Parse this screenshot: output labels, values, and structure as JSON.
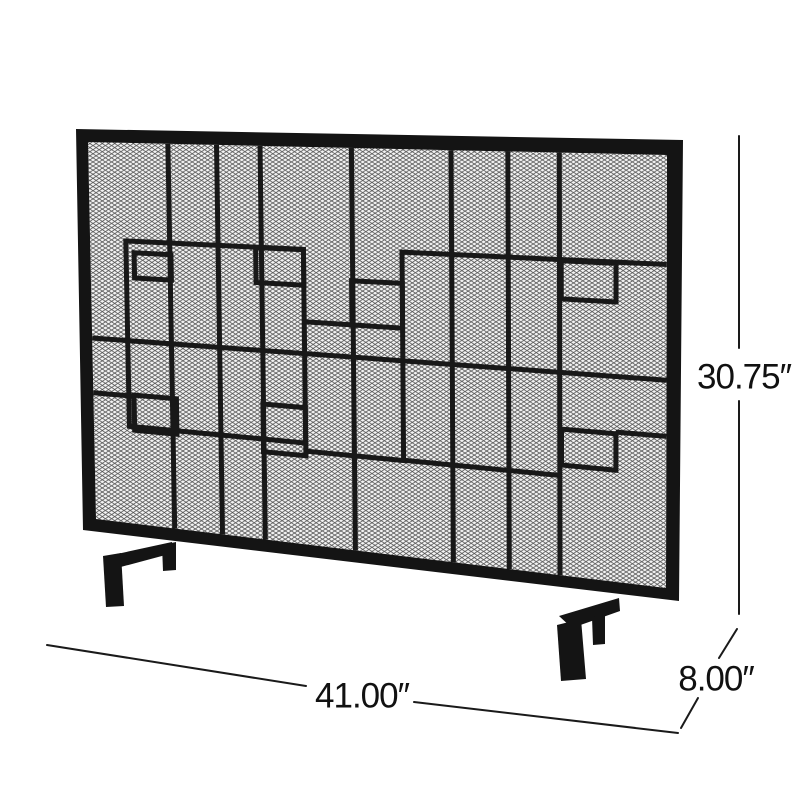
{
  "scene": {
    "background_color": "#ffffff",
    "description": "Black single-panel iron fireplace screen with mesh backing and geometric overlapping-squares pattern, shown as a product dimension diagram"
  },
  "product": {
    "frame_color": "#141414",
    "bar_color": "#181818",
    "mesh_line_color": "#4f4f4f",
    "mesh_background": "#f4f4f4"
  },
  "dimension_labels": {
    "width": "41.00″",
    "height": "30.75″",
    "depth": "8.00″"
  },
  "annotation": {
    "line_color": "#1a1a1a"
  }
}
